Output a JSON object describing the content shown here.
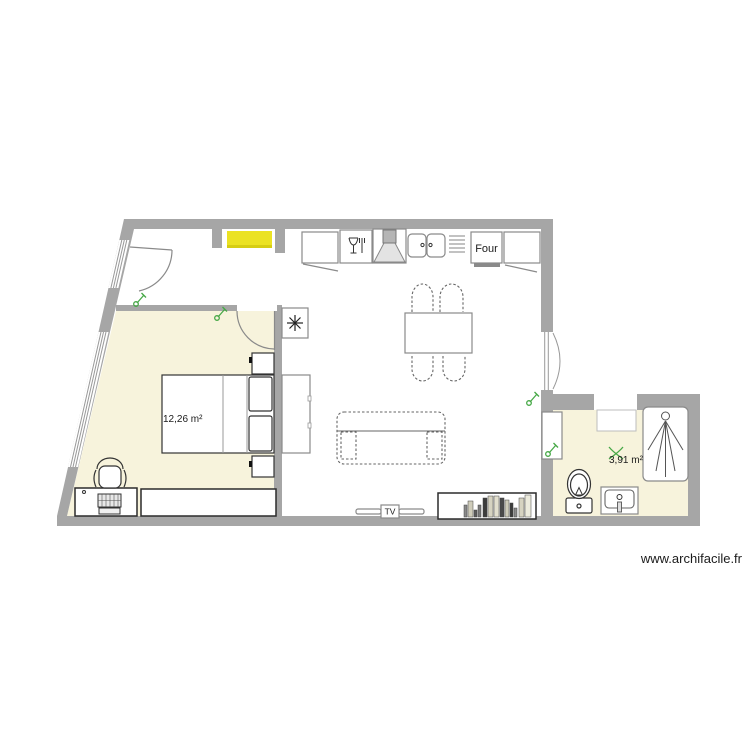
{
  "watermark": {
    "text": "www.archifacile.fr"
  },
  "rooms": [
    {
      "id": "bedroom",
      "area_label": "12,26 m²"
    },
    {
      "id": "bathroom",
      "area_label": "3,91 m²"
    }
  ],
  "kitchen": {
    "oven_label": "Four"
  },
  "living": {
    "tv_label": "TV"
  },
  "colors": {
    "wall": "#a6a6a6",
    "room_fill": "#f7f3dc",
    "selected_item_yellow": "#ebe223",
    "electric_symbol_green": "#46a846"
  },
  "icons": {
    "fridge-icon": "snowflake",
    "dishwasher-icon": "glass-and-fork",
    "hood-icon": "extractor-hood",
    "oven-icon": "labelled-box",
    "sink-icon": "double-bowl",
    "shower-icon": "shower-spray",
    "toilet-icon": "toilet",
    "washbasin-icon": "basin-with-tap",
    "switch-icon": "light-switch",
    "fan-icon": "ventilation-pinwheel",
    "tv-icon": "tv-on-stand"
  }
}
